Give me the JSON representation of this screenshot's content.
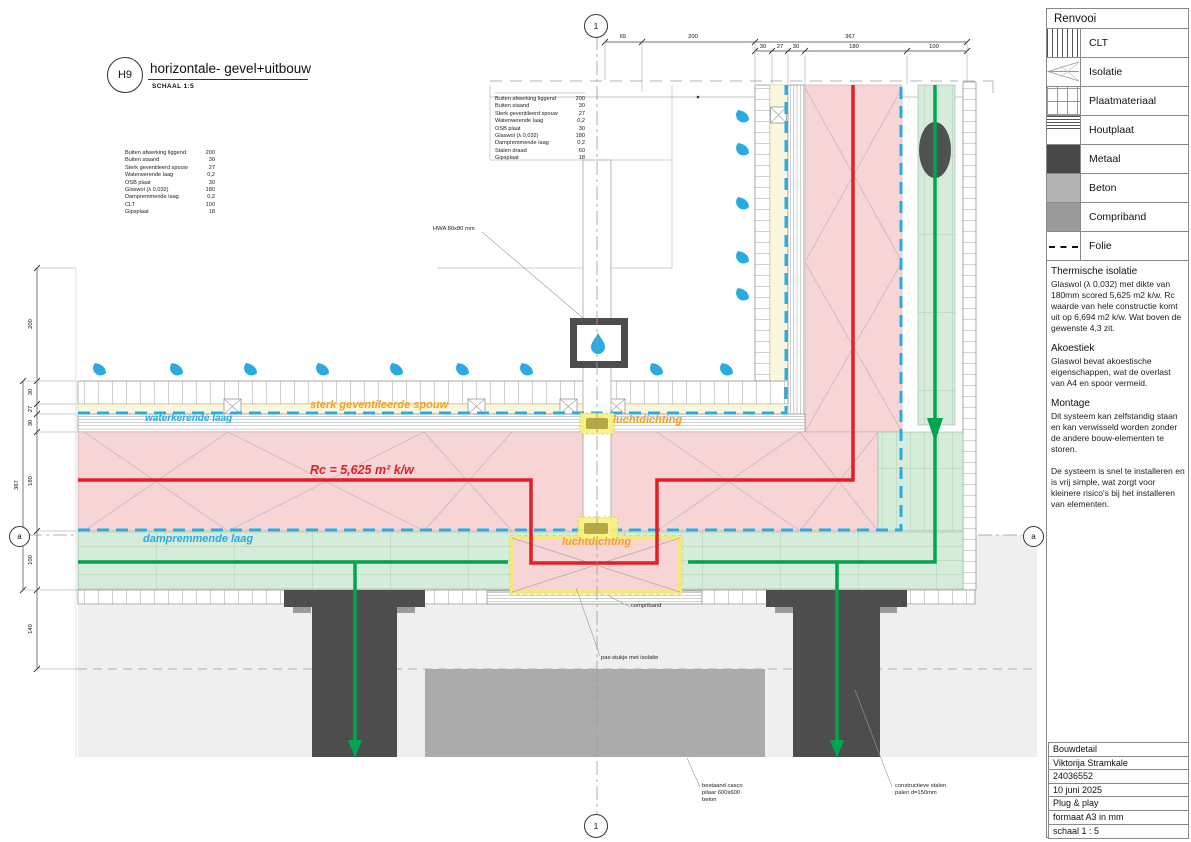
{
  "drawing_title": {
    "code": "H9",
    "title": "horizontale- gevel+uitbouw",
    "scale_note": "SCHAAL 1:5"
  },
  "grid_markers": {
    "top": "1",
    "bottom": "1",
    "left": "a",
    "right": "a"
  },
  "dimensions": {
    "top_main": [
      "65",
      "200",
      "367"
    ],
    "top_sub": [
      "30",
      "27",
      "30",
      "180",
      "100"
    ],
    "left": [
      "200",
      "30",
      "27",
      "30",
      "367",
      "180",
      "100",
      "140"
    ]
  },
  "material_schedule_wall": {
    "rows": [
      [
        "Buiten afwerking liggend",
        "200"
      ],
      [
        "Buiten staand",
        "30"
      ],
      [
        "Sterk geventileerd spouw",
        "27"
      ],
      [
        "Waterwerende laag",
        "0,2"
      ],
      [
        "OSB plaat",
        "30"
      ],
      [
        "Glaswol (λ 0,032)",
        "180"
      ],
      [
        "Dampremmende laag",
        "0,2"
      ],
      [
        "CLT",
        "100"
      ],
      [
        "Gipsplaat",
        "18"
      ]
    ]
  },
  "material_schedule_joint": {
    "rows": [
      [
        "Buiten afwerking liggend",
        "200"
      ],
      [
        "Buiten staand",
        "30"
      ],
      [
        "Sterk geventileerd spouw",
        "27"
      ],
      [
        "Waterwerende laag",
        "0,2"
      ],
      [
        "OSB plaat",
        "30"
      ],
      [
        "Glaswol (λ 0,032)",
        "180"
      ],
      [
        "Dampremmende laag",
        "0,2"
      ],
      [
        "Stalen draad",
        "60"
      ],
      [
        "Gipsplaat",
        "18"
      ]
    ]
  },
  "annotations": {
    "hwa": "HWA 80x80 mm",
    "sterk_geventileerde_spouw": "sterk geventileerde spouw",
    "waterkerende_laag": "waterkerende laag",
    "rc_value": "Rc = 5,625 m² k/w",
    "dampremmende_laag": "dampremmende laag",
    "luchtdichting_top": "luchtdichting",
    "luchtdichting_bottom": "luchtdichting",
    "compriband": "compriband",
    "pas_stukje": "pas-stukje met isolatie",
    "bestaand_pilaar": "bestaand casco\npilaar 600x600\nbeton",
    "stalen_palen": "constructieve stalen\npalen d=150mm"
  },
  "legend": {
    "title": "Renvooi",
    "items": [
      {
        "label": "CLT",
        "symbol": "clt-hatch"
      },
      {
        "label": "Isolatie",
        "symbol": "insulation-triangles"
      },
      {
        "label": "Plaatmateriaal",
        "symbol": "board-grid"
      },
      {
        "label": "Houtplaat",
        "symbol": "wood-lines"
      },
      {
        "label": "Metaal",
        "symbol": "solid-dark-gray"
      },
      {
        "label": "Beton",
        "symbol": "solid-gray"
      },
      {
        "label": "Compriband",
        "symbol": "solid-mid-gray"
      },
      {
        "label": "Folie",
        "symbol": "dashed-line"
      }
    ]
  },
  "notes": [
    {
      "heading": "Thermische isolatie",
      "body": "Glaswol (λ 0,032) met dikte van 180mm scored 5,625 m2 k/w. Rc waarde van hele constructie komt uit op 6,694 m2 k/w. Wat boven de gewenste 4,3 zit."
    },
    {
      "heading": "Akoestiek",
      "body": "Glaswol bevat akoestische eigenschappen, wat de overlast van A4 en spoor vermeid."
    },
    {
      "heading": "Montage",
      "body": "Dit systeem kan zelfstandig staan en kan verwisseld worden zonder de andere bouw-elementen te storen.\n\nDe systeem is snel te installeren en is vrij simple, wat zorgt voor kleinere risico's bij het installeren van elementen."
    }
  ],
  "title_block": {
    "rows": [
      "Bouwdetail",
      "Viktorija Stramkale",
      "24036552",
      "10 juni 2025",
      "Plug & play",
      "formaat A3 in mm",
      "schaal 1 : 5"
    ]
  },
  "colors": {
    "insulation_pink": "#f7d5d6",
    "clt_green": "#d6ecdb",
    "cavity_yellow": "#faf7dd",
    "water_layer_blue": "#29abe2",
    "rc_red": "#e31e26",
    "load_path_green": "#00a550",
    "label_orange": "#f6a21d",
    "metal_dark": "#474747",
    "concrete_gray": "#b3b3b3",
    "compriband_gray": "#9a9a9a"
  }
}
